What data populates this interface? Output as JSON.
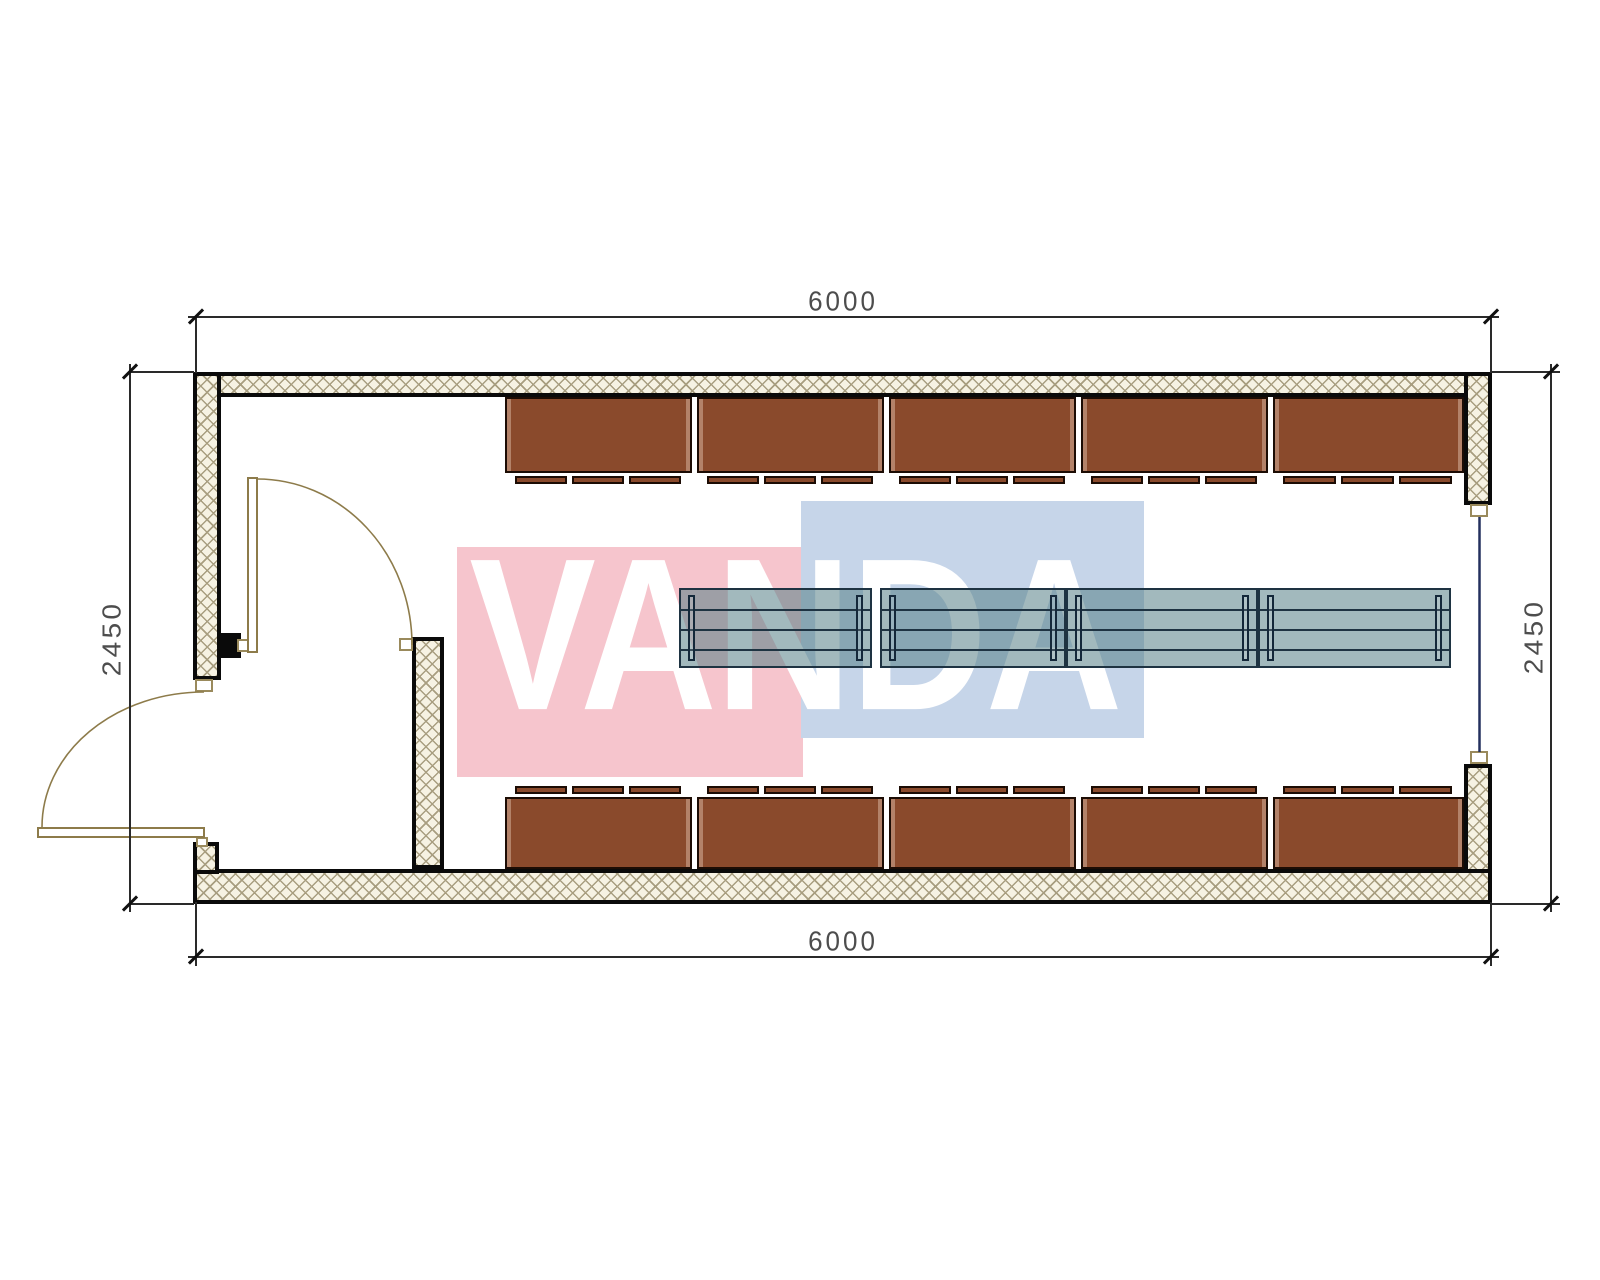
{
  "drawing": {
    "type": "architectural floor plan, 6.0 x 2.45 m modular unit",
    "background": "#ffffff"
  },
  "dimensions": {
    "top": "6000",
    "bottom": "6000",
    "left": "2450",
    "right": "2450"
  },
  "watermark": {
    "text": "VANDA",
    "red_square": "#f6c5cd",
    "blue_square": "#c6d5e9",
    "text_color": "#ffffff"
  },
  "colors": {
    "wall_hatch_bg": "#f6f2e3",
    "wall_hatch_line": "#a89e80",
    "wall_outline": "#0a0a0a",
    "cabinet_fill": "#8a4a2c",
    "cabinet_outline": "#1c0c04",
    "table_fill": "rgba(86,128,134,0.55)",
    "table_outline": "#1e3342",
    "door_swing_line": "#8d7b4a",
    "window_glazing_line": "#24305e",
    "dimension_line": "#2a2a2a",
    "dimension_text": "#4d4d4d"
  },
  "counts": {
    "cabinet_rows": 2,
    "cabinet_modules_per_row": 5,
    "table_modules": 4,
    "doors": 2,
    "windows": 1
  }
}
